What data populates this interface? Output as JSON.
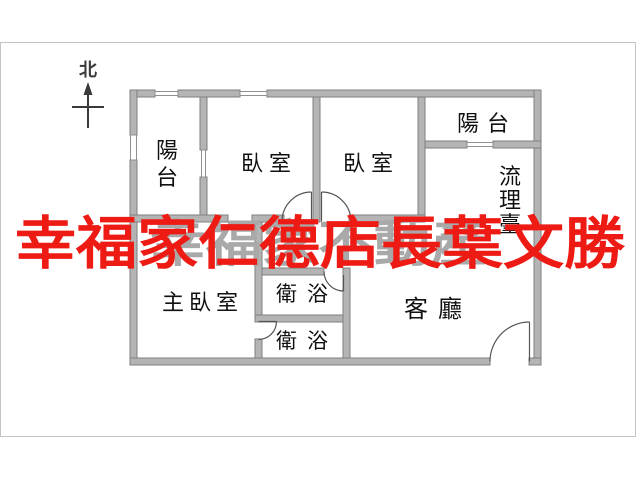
{
  "compass": {
    "label": "北"
  },
  "watermarks": {
    "red": {
      "text": "幸福家仁德店長葉文勝",
      "color": "#ee1b15"
    },
    "gray": {
      "text": "幸福家不動產",
      "color": "#a9a9a9"
    }
  },
  "rooms": {
    "balcony_left": {
      "name": "陽台",
      "chars": [
        "陽",
        "台"
      ]
    },
    "bedroom_left": {
      "name": "臥室"
    },
    "bedroom_right": {
      "name": "臥室"
    },
    "balcony_top_right": {
      "name": "陽台"
    },
    "kitchen_counter": {
      "name": "流理臺",
      "chars": [
        "流",
        "理",
        "臺"
      ]
    },
    "master_bedroom": {
      "name": "主臥室"
    },
    "bathroom_upper": {
      "name": "衛浴"
    },
    "bathroom_lower": {
      "name": "衛浴"
    },
    "living_room": {
      "name": "客廳"
    }
  },
  "colors": {
    "wall_fill": "#b4b4b4",
    "wall_stroke": "#7f7f7f",
    "window_stroke": "#8f8f8f",
    "door_line": "#555555",
    "compass": "#3a3a3a",
    "label": "#111111",
    "frame": "#c4c4c4"
  }
}
